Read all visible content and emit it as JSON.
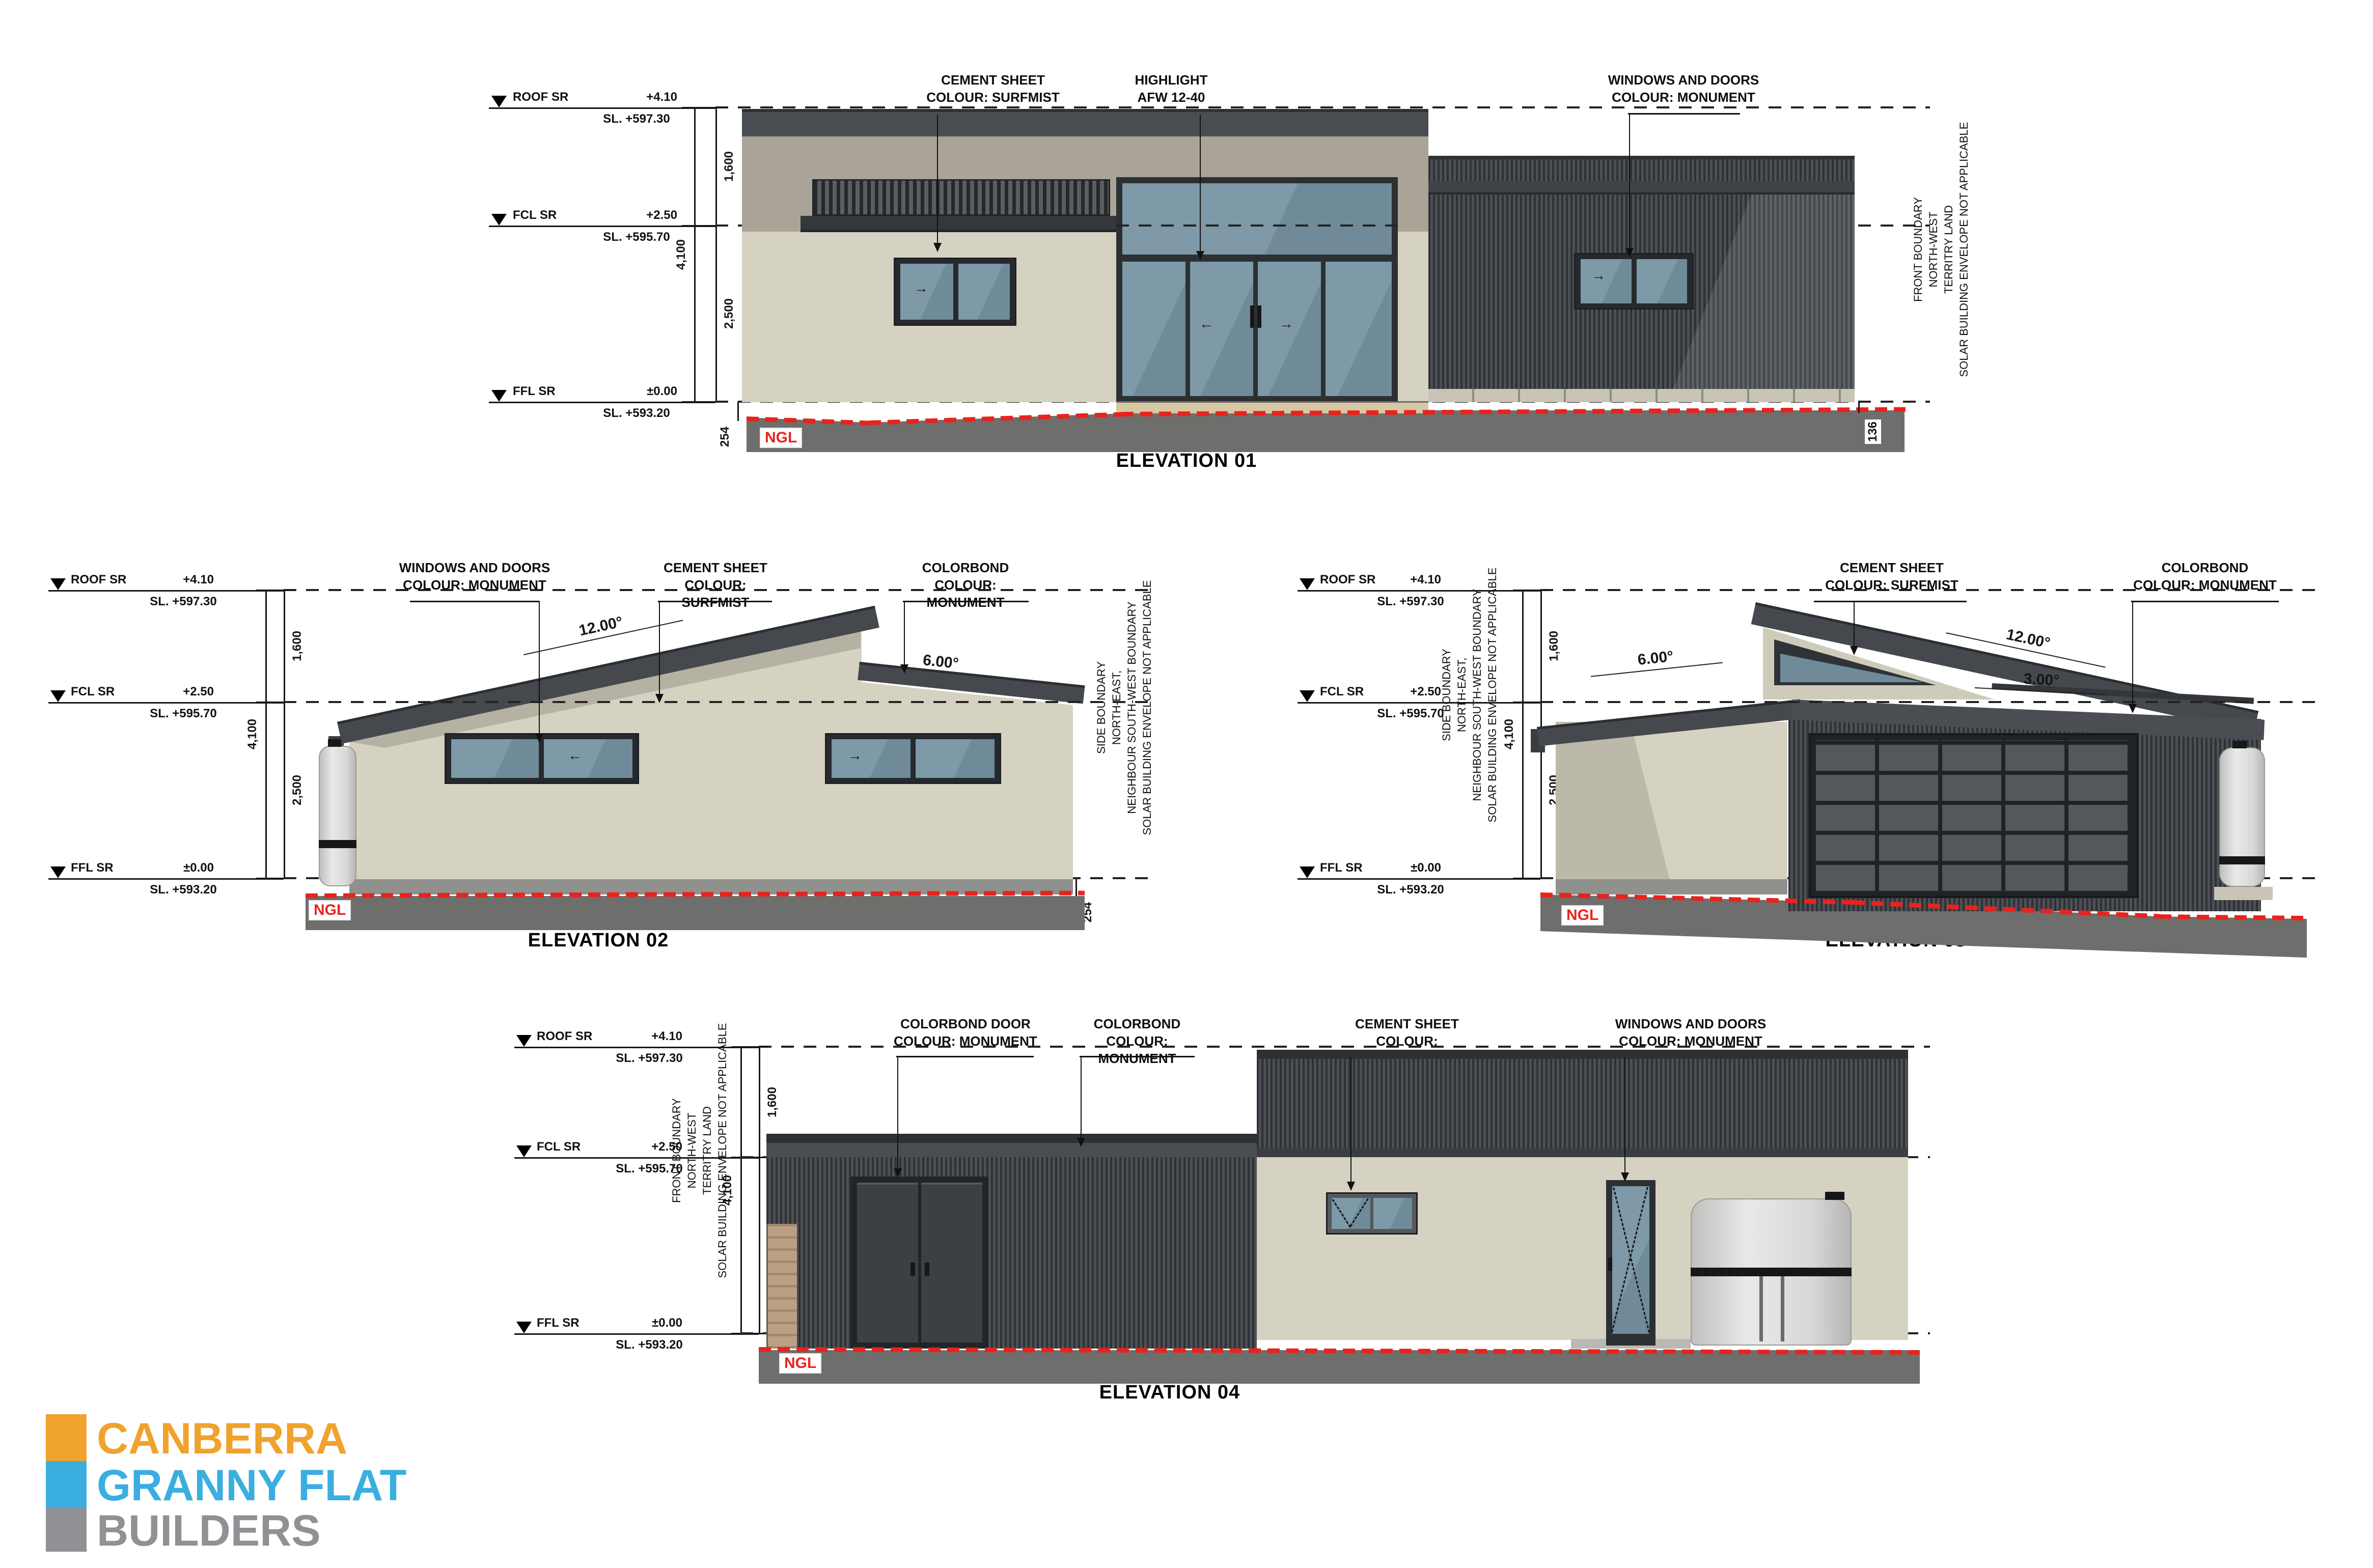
{
  "levels": {
    "roof": {
      "name": "ROOF SR",
      "rl": "+4.10",
      "sl": "SL. +597.30"
    },
    "fcl": {
      "name": "FCL SR",
      "rl": "+2.50",
      "sl": "SL. +595.70"
    },
    "ffl": {
      "name": "FFL SR",
      "rl": "±0.00",
      "sl": "SL. +593.20"
    }
  },
  "dims": {
    "roof_fcl": "1,600",
    "overall": "4,100",
    "fcl_ffl": "2,500",
    "ngl_e1_left": "254",
    "ngl_e1_right": "136",
    "ngl_e2_right": "254"
  },
  "ngl": "NGL",
  "boundary_front": [
    "FRONT BOUNDARY",
    "NORTH-WEST",
    "TERRITRY LAND",
    "SOLAR BUILDING ENVELOPE NOT APPLICABLE"
  ],
  "boundary_side": [
    "SIDE BOUNDARY",
    "NORTH-EAST,",
    "NEIGHBOUR SOUTH-WEST BOUNDARY",
    "SOLAR BUILDING ENVELOPE NOT APPLICABLE"
  ],
  "e1": {
    "title": "ELEVATION 01",
    "c1": [
      "CEMENT SHEET",
      "COLOUR: SURFMIST"
    ],
    "c2": [
      "HIGHLIGHT",
      "AFW 12-40"
    ],
    "c3": [
      "WINDOWS AND DOORS",
      "COLOUR: MONUMENT"
    ]
  },
  "e2": {
    "title": "ELEVATION 02",
    "c1": [
      "WINDOWS AND DOORS",
      "COLOUR: MONUMENT"
    ],
    "c2": [
      "CEMENT SHEET",
      "COLOUR: SURFMIST"
    ],
    "c3": [
      "COLORBOND",
      "COLOUR: MONUMENT"
    ],
    "a12": "12.00°",
    "a6": "6.00°"
  },
  "e3": {
    "title": "ELEVATION 03",
    "c1": [
      "CEMENT SHEET",
      "COLOUR: SURFMIST"
    ],
    "c2": [
      "COLORBOND",
      "COLOUR: MONUMENT"
    ],
    "a6": "6.00°",
    "a12": "12.00°",
    "a3": "3.00°"
  },
  "e4": {
    "title": "ELEVATION 04",
    "c1": [
      "COLORBOND DOOR",
      "COLOUR: MONUMENT"
    ],
    "c2": [
      "COLORBOND",
      "COLOUR: MONUMENT"
    ],
    "c3": [
      "CEMENT SHEET",
      "COLOUR: SURFMIST"
    ],
    "c4": [
      "WINDOWS AND DOORS",
      "COLOUR: MONUMENT"
    ]
  },
  "logo": {
    "l1": "CANBERRA",
    "l2": "GRANNY FLAT",
    "l3": "BUILDERS",
    "colors": {
      "orange": "#EFA32D",
      "blue": "#3BAEE0",
      "gray": "#8F9194"
    }
  },
  "colors": {
    "surfmist_wall": "#D6D2C2",
    "monument_dark": "#45484C",
    "glass_blue": "#7E99A7",
    "ngl_red": "#E8231E",
    "ground_gray": "#6E6E6C"
  }
}
